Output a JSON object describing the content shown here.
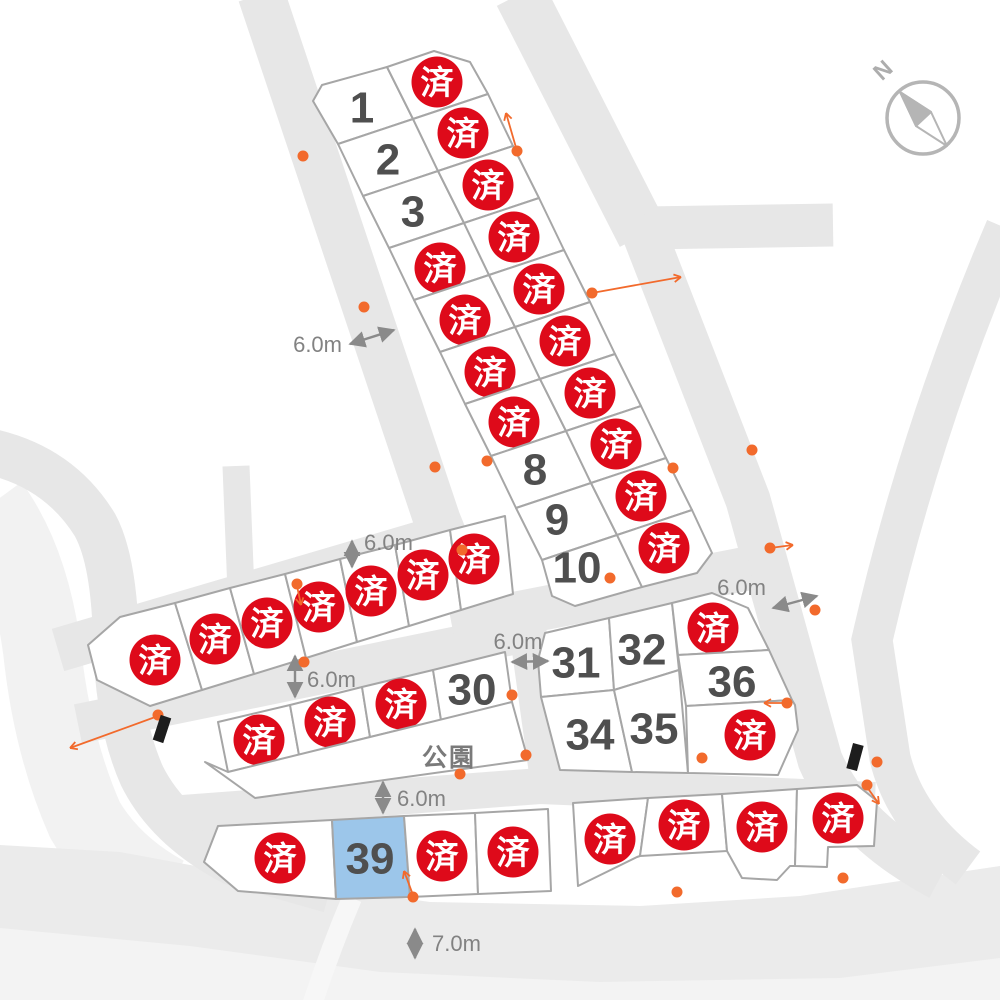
{
  "meta": {
    "type": "land-lot-subdivision-map"
  },
  "colors": {
    "road": "#e7e7e7",
    "road_light": "#f2f2f2",
    "band_bottom": "#ebebeb",
    "band_bottom_light": "#f3f3f3",
    "lot_fill": "#ffffff",
    "lot_stroke": "#a6a6a6",
    "lot_selected_fill": "#9cc6ea",
    "sold_badge": "#de0a1a",
    "sold_text": "#ffffff",
    "number_text": "#4f4f4f",
    "dim_color": "#8a8a8a",
    "orange": "#f26a2c",
    "compass": "#b5b5b5",
    "marker_black": "#1d1d1d"
  },
  "compass": {
    "label": "N",
    "cx": 923,
    "cy": 118,
    "r": 36,
    "label_x": 888,
    "label_y": 76,
    "label_rotate": -42,
    "needle_north": "900,92 931,112 916,126",
    "needle_outline": "900,92 931,112 947,146 916,126"
  },
  "roads": [
    {
      "name": "road-left-outer-light",
      "d": "M -10,505 Q 30,560 42,650 Q 52,745 85,820 Q 112,866 165,895",
      "w": 78,
      "c": "#f2f2f2"
    },
    {
      "name": "band-bottom",
      "poly": "0,845 120,852 260,878 430,902 640,906 800,896 920,878 1000,866 1000,1000 0,1000",
      "c": "#ebebeb"
    },
    {
      "name": "band-bottom-light",
      "poly": "0,928 190,946 380,972 600,982 840,978 1000,958 1000,1000 0,1000",
      "c": "#f3f3f3"
    },
    {
      "name": "path-bottom-light",
      "d": "M 352,898 Q 330,950 312,1005",
      "w": 20,
      "c": "#f7f7f7"
    },
    {
      "name": "road-left-curve",
      "d": "M -8,452 Q 60,468 95,525 Q 114,560 116,640 Q 118,722 142,776 Q 168,828 232,862 L 330,890",
      "w": 46,
      "c": "#e7e7e7"
    },
    {
      "name": "road-stub",
      "d": "M 236,466 L 241,592",
      "w": 27,
      "c": "#e7e7e7"
    },
    {
      "name": "road-northwest",
      "d": "M 261,-6 L 437,520 L 458,572",
      "w": 47,
      "c": "#e7e7e7"
    },
    {
      "name": "road-northeast",
      "d": "M 520,-6 L 643,235",
      "w": 52,
      "c": "#e7e7e7"
    },
    {
      "name": "road-branch-east",
      "d": "M 645,228 L 833,225",
      "w": 43,
      "c": "#e7e7e7"
    },
    {
      "name": "road-east-main",
      "d": "M 640,222 L 748,500 L 820,760 Q 850,830 940,878",
      "w": 45,
      "c": "#e7e7e7"
    },
    {
      "name": "road-east-outer",
      "d": "M 1006,228 Q 920,430 872,640 L 890,758 Q 906,822 968,868",
      "w": 41,
      "c": "#e7e7e7"
    },
    {
      "name": "road-mid-upper",
      "d": "M 58,650 L 455,533",
      "w": 44,
      "c": "#e7e7e7"
    },
    {
      "name": "road-mid-lower",
      "d": "M 78,724 L 546,628",
      "w": 40,
      "c": "#e7e7e7"
    },
    {
      "name": "road-center",
      "d": "M 452,626 L 750,568",
      "w": 44,
      "c": "#e7e7e7"
    },
    {
      "name": "road-vertical-mid",
      "d": "M 528,636 L 548,780",
      "w": 36,
      "c": "#e7e7e7"
    },
    {
      "name": "road-south-mid",
      "d": "M 183,813 L 540,786 L 875,800",
      "w": 36,
      "c": "#e7e7e7"
    }
  ],
  "lots": [
    {
      "name": "lot-1",
      "label": "1",
      "status": "available",
      "points": "313,101 322,85 387,67 413,119 338,144",
      "lx": 362,
      "ly": 106
    },
    {
      "name": "lot-2",
      "label": "2",
      "status": "available",
      "points": "338,144 413,119 438,171 363,196",
      "lx": 388,
      "ly": 158
    },
    {
      "name": "lot-3",
      "label": "3",
      "status": "available",
      "points": "363,196 438,171 464,223 389,248",
      "lx": 413,
      "ly": 210
    },
    {
      "name": "lot-sold-a1",
      "label": "済",
      "status": "sold",
      "points": "389,248 464,223 489,275 414,300",
      "lx": 440,
      "ly": 268
    },
    {
      "name": "lot-sold-a2",
      "label": "済",
      "status": "sold",
      "points": "414,300 489,275 515,327 440,352",
      "lx": 465,
      "ly": 320
    },
    {
      "name": "lot-sold-a3",
      "label": "済",
      "status": "sold",
      "points": "440,352 515,327 540,379 465,404",
      "lx": 490,
      "ly": 372
    },
    {
      "name": "lot-sold-a4",
      "label": "済",
      "status": "sold",
      "points": "465,404 540,379 566,431 491,456",
      "lx": 514,
      "ly": 422
    },
    {
      "name": "lot-8",
      "label": "8",
      "status": "available",
      "points": "491,456 566,431 591,483 516,508",
      "lx": 535,
      "ly": 468
    },
    {
      "name": "lot-9",
      "label": "9",
      "status": "available",
      "points": "516,508 591,483 617,535 542,560",
      "lx": 557,
      "ly": 518
    },
    {
      "name": "lot-10",
      "label": "10",
      "status": "available",
      "points": "542,560 617,535 642,587 575,606 552,596",
      "lx": 577,
      "ly": 566
    },
    {
      "name": "lot-sold-b1",
      "label": "済",
      "status": "sold",
      "points": "387,67 434,51 470,62 488,94 413,119",
      "lx": 437,
      "ly": 82
    },
    {
      "name": "lot-sold-b2",
      "label": "済",
      "status": "sold",
      "points": "413,119 488,94 513,146 438,171",
      "lx": 463,
      "ly": 133
    },
    {
      "name": "lot-sold-b3",
      "label": "済",
      "status": "sold",
      "points": "438,171 513,146 539,198 464,223",
      "lx": 488,
      "ly": 185
    },
    {
      "name": "lot-sold-b4",
      "label": "済",
      "status": "sold",
      "points": "464,223 539,198 564,250 489,275",
      "lx": 514,
      "ly": 237
    },
    {
      "name": "lot-sold-b5",
      "label": "済",
      "status": "sold",
      "points": "489,275 564,250 590,302 515,327",
      "lx": 539,
      "ly": 289
    },
    {
      "name": "lot-sold-b6",
      "label": "済",
      "status": "sold",
      "points": "515,327 590,302 615,354 540,379",
      "lx": 565,
      "ly": 341
    },
    {
      "name": "lot-sold-b7",
      "label": "済",
      "status": "sold",
      "points": "540,379 615,354 641,406 566,431",
      "lx": 590,
      "ly": 393
    },
    {
      "name": "lot-sold-b8",
      "label": "済",
      "status": "sold",
      "points": "566,431 641,406 666,458 591,483",
      "lx": 616,
      "ly": 444
    },
    {
      "name": "lot-sold-b9",
      "label": "済",
      "status": "sold",
      "points": "591,483 666,458 692,510 617,535",
      "lx": 641,
      "ly": 496
    },
    {
      "name": "lot-sold-b10",
      "label": "済",
      "status": "sold",
      "points": "617,535 692,510 712,553 697,573 642,587",
      "lx": 664,
      "ly": 548
    },
    {
      "name": "lot-sold-c1",
      "label": "済",
      "status": "sold",
      "points": "120,617 175,603 202,690 150,706 97,680 88,645",
      "lx": 155,
      "ly": 660
    },
    {
      "name": "lot-sold-c2",
      "label": "済",
      "status": "sold",
      "points": "175,603 230,588 254,674 202,690",
      "lx": 215,
      "ly": 639
    },
    {
      "name": "lot-sold-c3",
      "label": "済",
      "status": "sold",
      "points": "230,588 285,574 306,658 254,674",
      "lx": 267,
      "ly": 623
    },
    {
      "name": "lot-sold-c4",
      "label": "済",
      "status": "sold",
      "points": "285,574 340,559 357,642 306,658",
      "lx": 319,
      "ly": 607
    },
    {
      "name": "lot-sold-c5",
      "label": "済",
      "status": "sold",
      "points": "340,559 395,545 409,626 357,642",
      "lx": 371,
      "ly": 591
    },
    {
      "name": "lot-sold-c6",
      "label": "済",
      "status": "sold",
      "points": "395,545 450,530 461,610 409,626",
      "lx": 423,
      "ly": 575
    },
    {
      "name": "lot-sold-c7",
      "label": "済",
      "status": "sold",
      "points": "450,530 505,516 513,594 461,610",
      "lx": 474,
      "ly": 559
    },
    {
      "name": "lot-sold-d1",
      "label": "済",
      "status": "sold",
      "points": "218,722 290,705 299,755 228,772",
      "lx": 259,
      "ly": 740
    },
    {
      "name": "lot-sold-d2",
      "label": "済",
      "status": "sold",
      "points": "290,705 362,687 370,737 299,755",
      "lx": 330,
      "ly": 722
    },
    {
      "name": "lot-sold-d3",
      "label": "済",
      "status": "sold",
      "points": "362,687 433,670 441,720 370,737",
      "lx": 401,
      "ly": 704
    },
    {
      "name": "lot-30",
      "label": "30",
      "status": "available",
      "points": "433,670 505,652 512,702 441,720",
      "lx": 472,
      "ly": 688
    },
    {
      "name": "park",
      "label": "公園",
      "status": "park",
      "points": "228,772 512,702 528,760 255,798 205,762",
      "lx": 449,
      "ly": 757
    },
    {
      "name": "lot-31",
      "label": "31",
      "status": "available",
      "points": "545,633 609,618 614,690 541,697 538,660",
      "lx": 576,
      "ly": 661
    },
    {
      "name": "lot-32",
      "label": "32",
      "status": "available",
      "points": "609,618 672,603 679,670 614,690",
      "lx": 642,
      "ly": 648
    },
    {
      "name": "lot-34",
      "label": "34",
      "status": "available",
      "points": "541,697 614,690 632,772 560,770",
      "lx": 590,
      "ly": 733
    },
    {
      "name": "lot-35",
      "label": "35",
      "status": "available",
      "points": "614,690 679,670 688,773 632,772",
      "lx": 654,
      "ly": 727
    },
    {
      "name": "lot-sold-e1",
      "label": "済",
      "status": "sold",
      "points": "672,603 712,593 748,608 769,650 678,655",
      "lx": 713,
      "ly": 628
    },
    {
      "name": "lot-36",
      "label": "36",
      "status": "available",
      "points": "678,655 769,650 792,700 686,706",
      "lx": 732,
      "ly": 680
    },
    {
      "name": "lot-sold-e2",
      "label": "済",
      "status": "sold",
      "points": "686,706 792,700 795,705 798,730 778,775 688,773",
      "lx": 750,
      "ly": 735
    },
    {
      "name": "lot-sold-f1",
      "label": "済",
      "status": "sold",
      "points": "218,826 332,820 336,899 238,891 204,862",
      "lx": 280,
      "ly": 858
    },
    {
      "name": "lot-39",
      "label": "39",
      "status": "selected",
      "points": "332,820 404,816 410,897 336,899",
      "lx": 370,
      "ly": 857
    },
    {
      "name": "lot-sold-f2",
      "label": "済",
      "status": "sold",
      "points": "404,816 475,813 478,894 410,897",
      "lx": 442,
      "ly": 856
    },
    {
      "name": "lot-sold-f3",
      "label": "済",
      "status": "sold",
      "points": "475,813 548,809 551,891 478,894",
      "lx": 513,
      "ly": 852
    },
    {
      "name": "lot-sold-g1",
      "label": "済",
      "status": "sold",
      "points": "573,803 648,798 640,856 637,857 578,886",
      "lx": 610,
      "ly": 839
    },
    {
      "name": "lot-sold-g2",
      "label": "済",
      "status": "sold",
      "points": "648,798 722,794 727,851 640,856",
      "lx": 684,
      "ly": 825
    },
    {
      "name": "lot-sold-g3",
      "label": "済",
      "status": "sold",
      "points": "722,794 797,789 795,866 790,866 777,880 742,878 727,851",
      "lx": 762,
      "ly": 827
    },
    {
      "name": "lot-sold-g4",
      "label": "済",
      "status": "sold",
      "points": "797,789 857,785 877,801 874,846 828,847 827,867 795,866",
      "lx": 838,
      "ly": 818
    }
  ],
  "dimensions": [
    {
      "label": "6.0m",
      "x1": 350,
      "y1": 344,
      "x2": 394,
      "y2": 330,
      "lx": 342,
      "ly": 352,
      "anchor": "end"
    },
    {
      "label": "6.0m",
      "x1": 352,
      "y1": 541,
      "x2": 352,
      "y2": 567,
      "lx": 364,
      "ly": 550,
      "anchor": "start"
    },
    {
      "label": "6.0m",
      "x1": 295,
      "y1": 656,
      "x2": 295,
      "y2": 697,
      "lx": 307,
      "ly": 687,
      "anchor": "start"
    },
    {
      "label": "6.0m",
      "x1": 773,
      "y1": 608,
      "x2": 817,
      "y2": 596,
      "lx": 766,
      "ly": 595,
      "anchor": "end"
    },
    {
      "label": "6.0m",
      "x1": 512,
      "y1": 662,
      "x2": 548,
      "y2": 661,
      "lx": 518,
      "ly": 649,
      "anchor": "middle"
    },
    {
      "label": "6.0m",
      "x1": 383,
      "y1": 782,
      "x2": 383,
      "y2": 813,
      "lx": 397,
      "ly": 806,
      "anchor": "start"
    },
    {
      "label": "7.0m",
      "x1": 415,
      "y1": 929,
      "x2": 415,
      "y2": 958,
      "lx": 432,
      "ly": 951,
      "anchor": "start"
    }
  ],
  "survey_dots": [
    [
      303,
      156
    ],
    [
      364,
      307
    ],
    [
      435,
      467
    ],
    [
      487,
      461
    ],
    [
      517,
      151
    ],
    [
      592,
      293
    ],
    [
      673,
      468
    ],
    [
      752,
      450
    ],
    [
      770,
      548
    ],
    [
      815,
      610
    ],
    [
      787,
      703
    ],
    [
      877,
      762
    ],
    [
      867,
      785
    ],
    [
      843,
      878
    ],
    [
      677,
      892
    ],
    [
      413,
      897
    ],
    [
      304,
      662
    ],
    [
      297,
      584
    ],
    [
      462,
      550
    ],
    [
      158,
      715
    ],
    [
      610,
      578
    ],
    [
      512,
      695
    ],
    [
      526,
      755
    ],
    [
      460,
      774
    ],
    [
      702,
      758
    ]
  ],
  "orange_arrows": [
    {
      "x1": 517,
      "y1": 151,
      "x2": 506,
      "y2": 113
    },
    {
      "x1": 592,
      "y1": 293,
      "x2": 681,
      "y2": 277
    },
    {
      "x1": 297,
      "y1": 586,
      "x2": 301,
      "y2": 605
    },
    {
      "x1": 770,
      "y1": 548,
      "x2": 793,
      "y2": 545
    },
    {
      "x1": 787,
      "y1": 703,
      "x2": 764,
      "y2": 703
    },
    {
      "x1": 867,
      "y1": 787,
      "x2": 879,
      "y2": 804
    },
    {
      "x1": 413,
      "y1": 895,
      "x2": 404,
      "y2": 871
    },
    {
      "x1": 158,
      "y1": 716,
      "x2": 70,
      "y2": 748
    }
  ],
  "black_markers": [
    {
      "x": 162,
      "y": 729,
      "angle": 18
    },
    {
      "x": 855,
      "y": 757,
      "angle": 15
    }
  ]
}
